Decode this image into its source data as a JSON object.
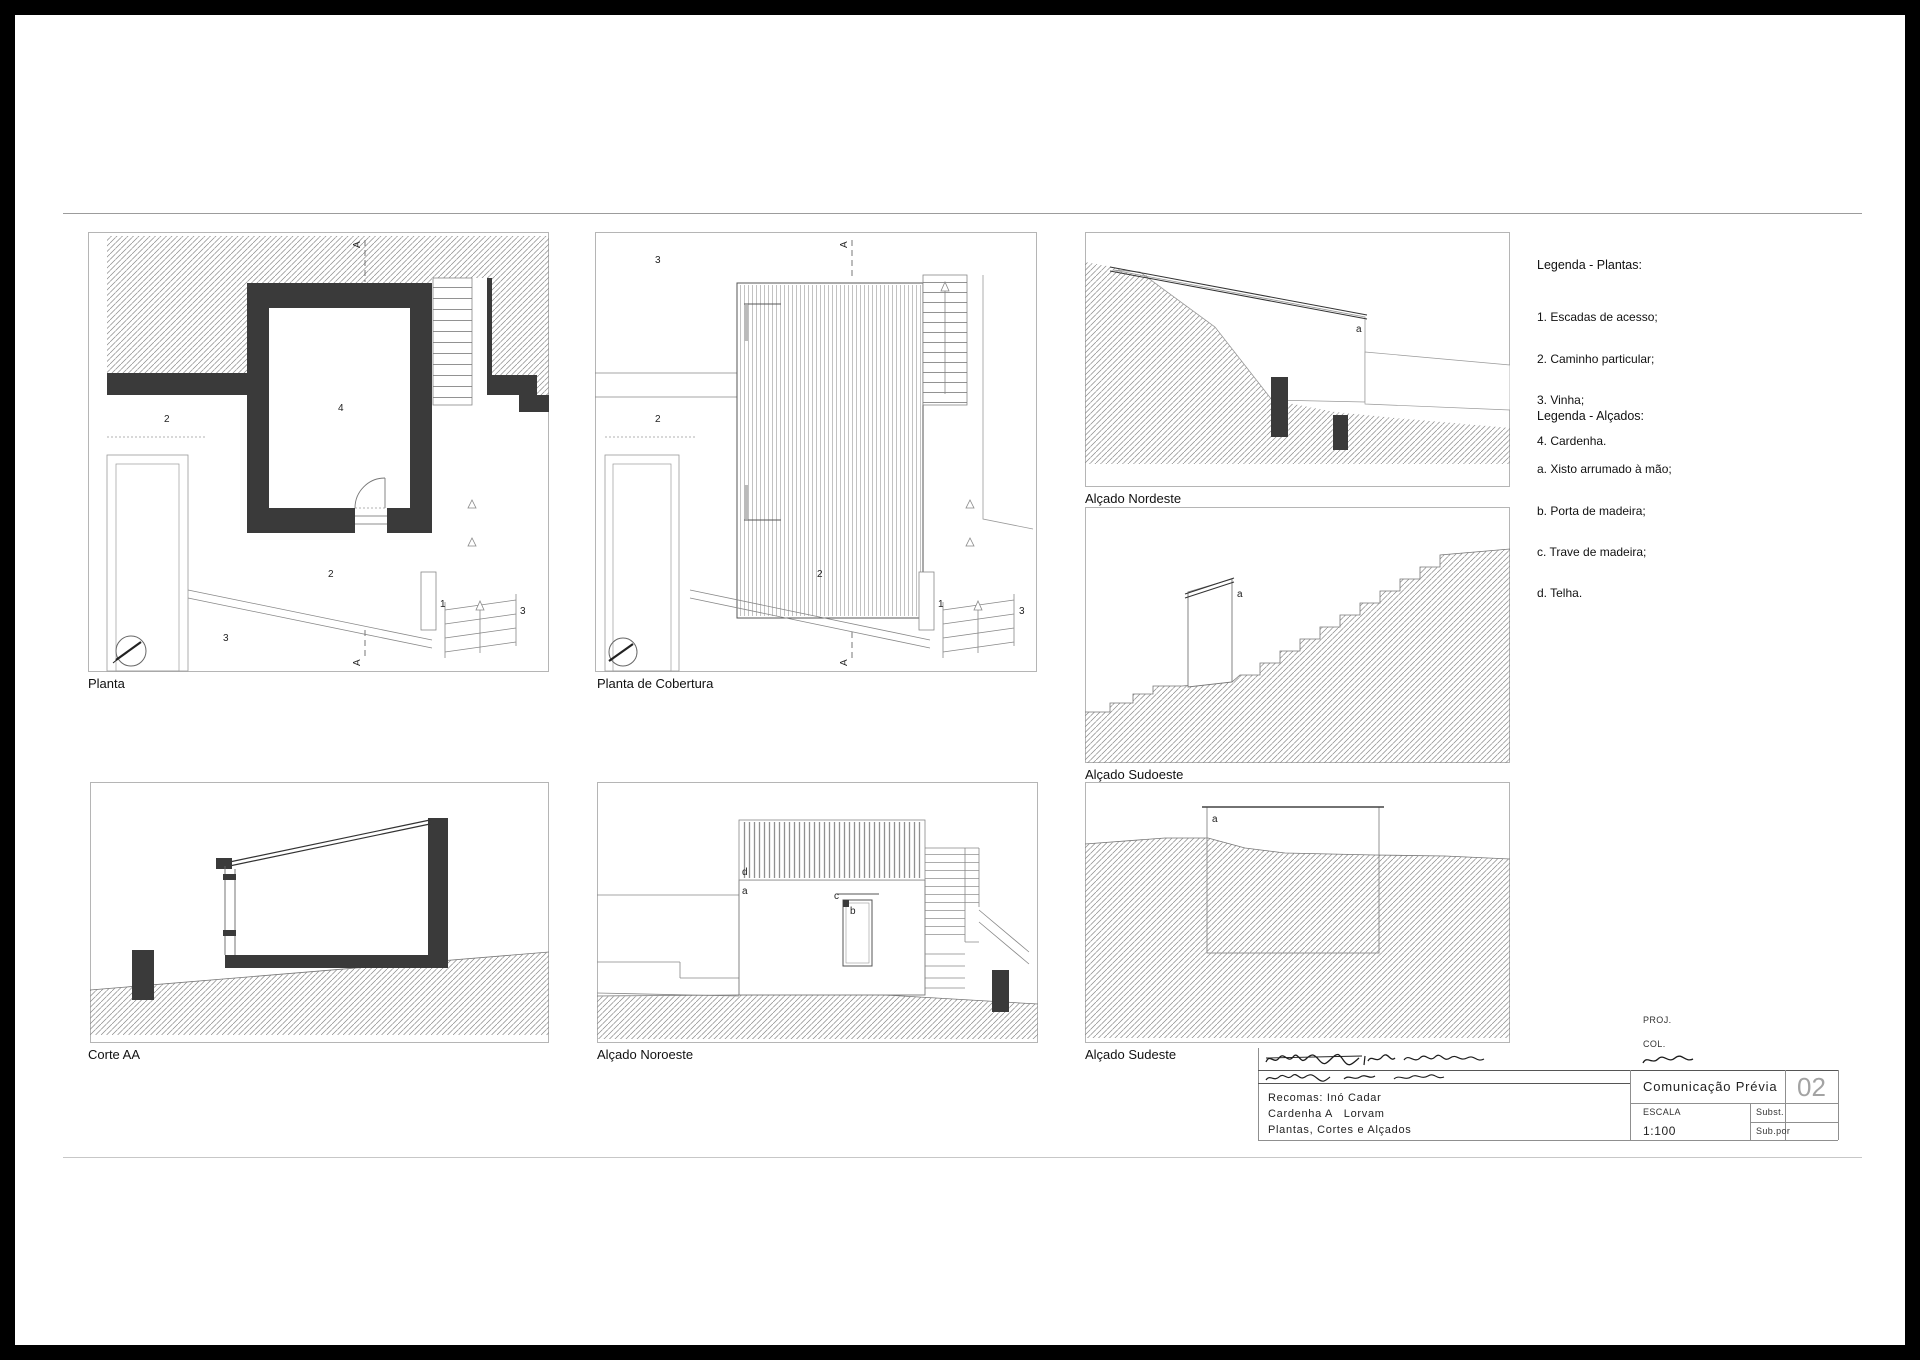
{
  "sheet": {
    "number": "02",
    "doc_type": "Comunicação Prévia",
    "proj_label": "PROJ.",
    "col_label": "COL.",
    "escala_label": "ESCALA",
    "escala_value": "1:100",
    "subst_label": "Subst.",
    "subpor_label": "Sub.por",
    "content_line_1": "Recomas: Inó Cadar",
    "content_line_2": "Cardenha A   Lorvam",
    "content_line_3": "Plantas, Cortes e Alçados",
    "handwritten_notes": [
      "illegible-scribble-row-1",
      "illegible-scribble-row-2",
      "illegible-scribble-col"
    ]
  },
  "legend_plantas": {
    "title": "Legenda - Plantas:",
    "items": [
      "1. Escadas de acesso;",
      "2. Caminho particular;",
      "3. Vinha;",
      "4. Cardenha."
    ]
  },
  "legend_alcados": {
    "title": "Legenda - Alçados:",
    "items": [
      "a. Xisto arrumado à mão;",
      "b. Porta de madeira;",
      "c. Trave de madeira;",
      "d. Telha."
    ]
  },
  "panels": {
    "planta": {
      "caption": "Planta"
    },
    "cobertura": {
      "caption": "Planta de Cobertura"
    },
    "nordeste": {
      "caption": "Alçado Nordeste"
    },
    "sudoeste": {
      "caption": "Alçado Sudoeste"
    },
    "sudeste": {
      "caption": "Alçado Sudeste"
    },
    "corte": {
      "caption": "Corte AA"
    },
    "noroeste": {
      "caption": "Alçado Noroeste"
    }
  },
  "labels": {
    "n1": "1",
    "n2": "2",
    "n3": "3",
    "n4": "4",
    "a": "a",
    "b": "b",
    "c": "c",
    "d": "d",
    "section": "A"
  },
  "colors": {
    "wall_dark": "#3a3a3a",
    "hatch_line": "#8a8a8a",
    "drawing_line": "#777777",
    "panel_border": "#b5b5b5"
  }
}
